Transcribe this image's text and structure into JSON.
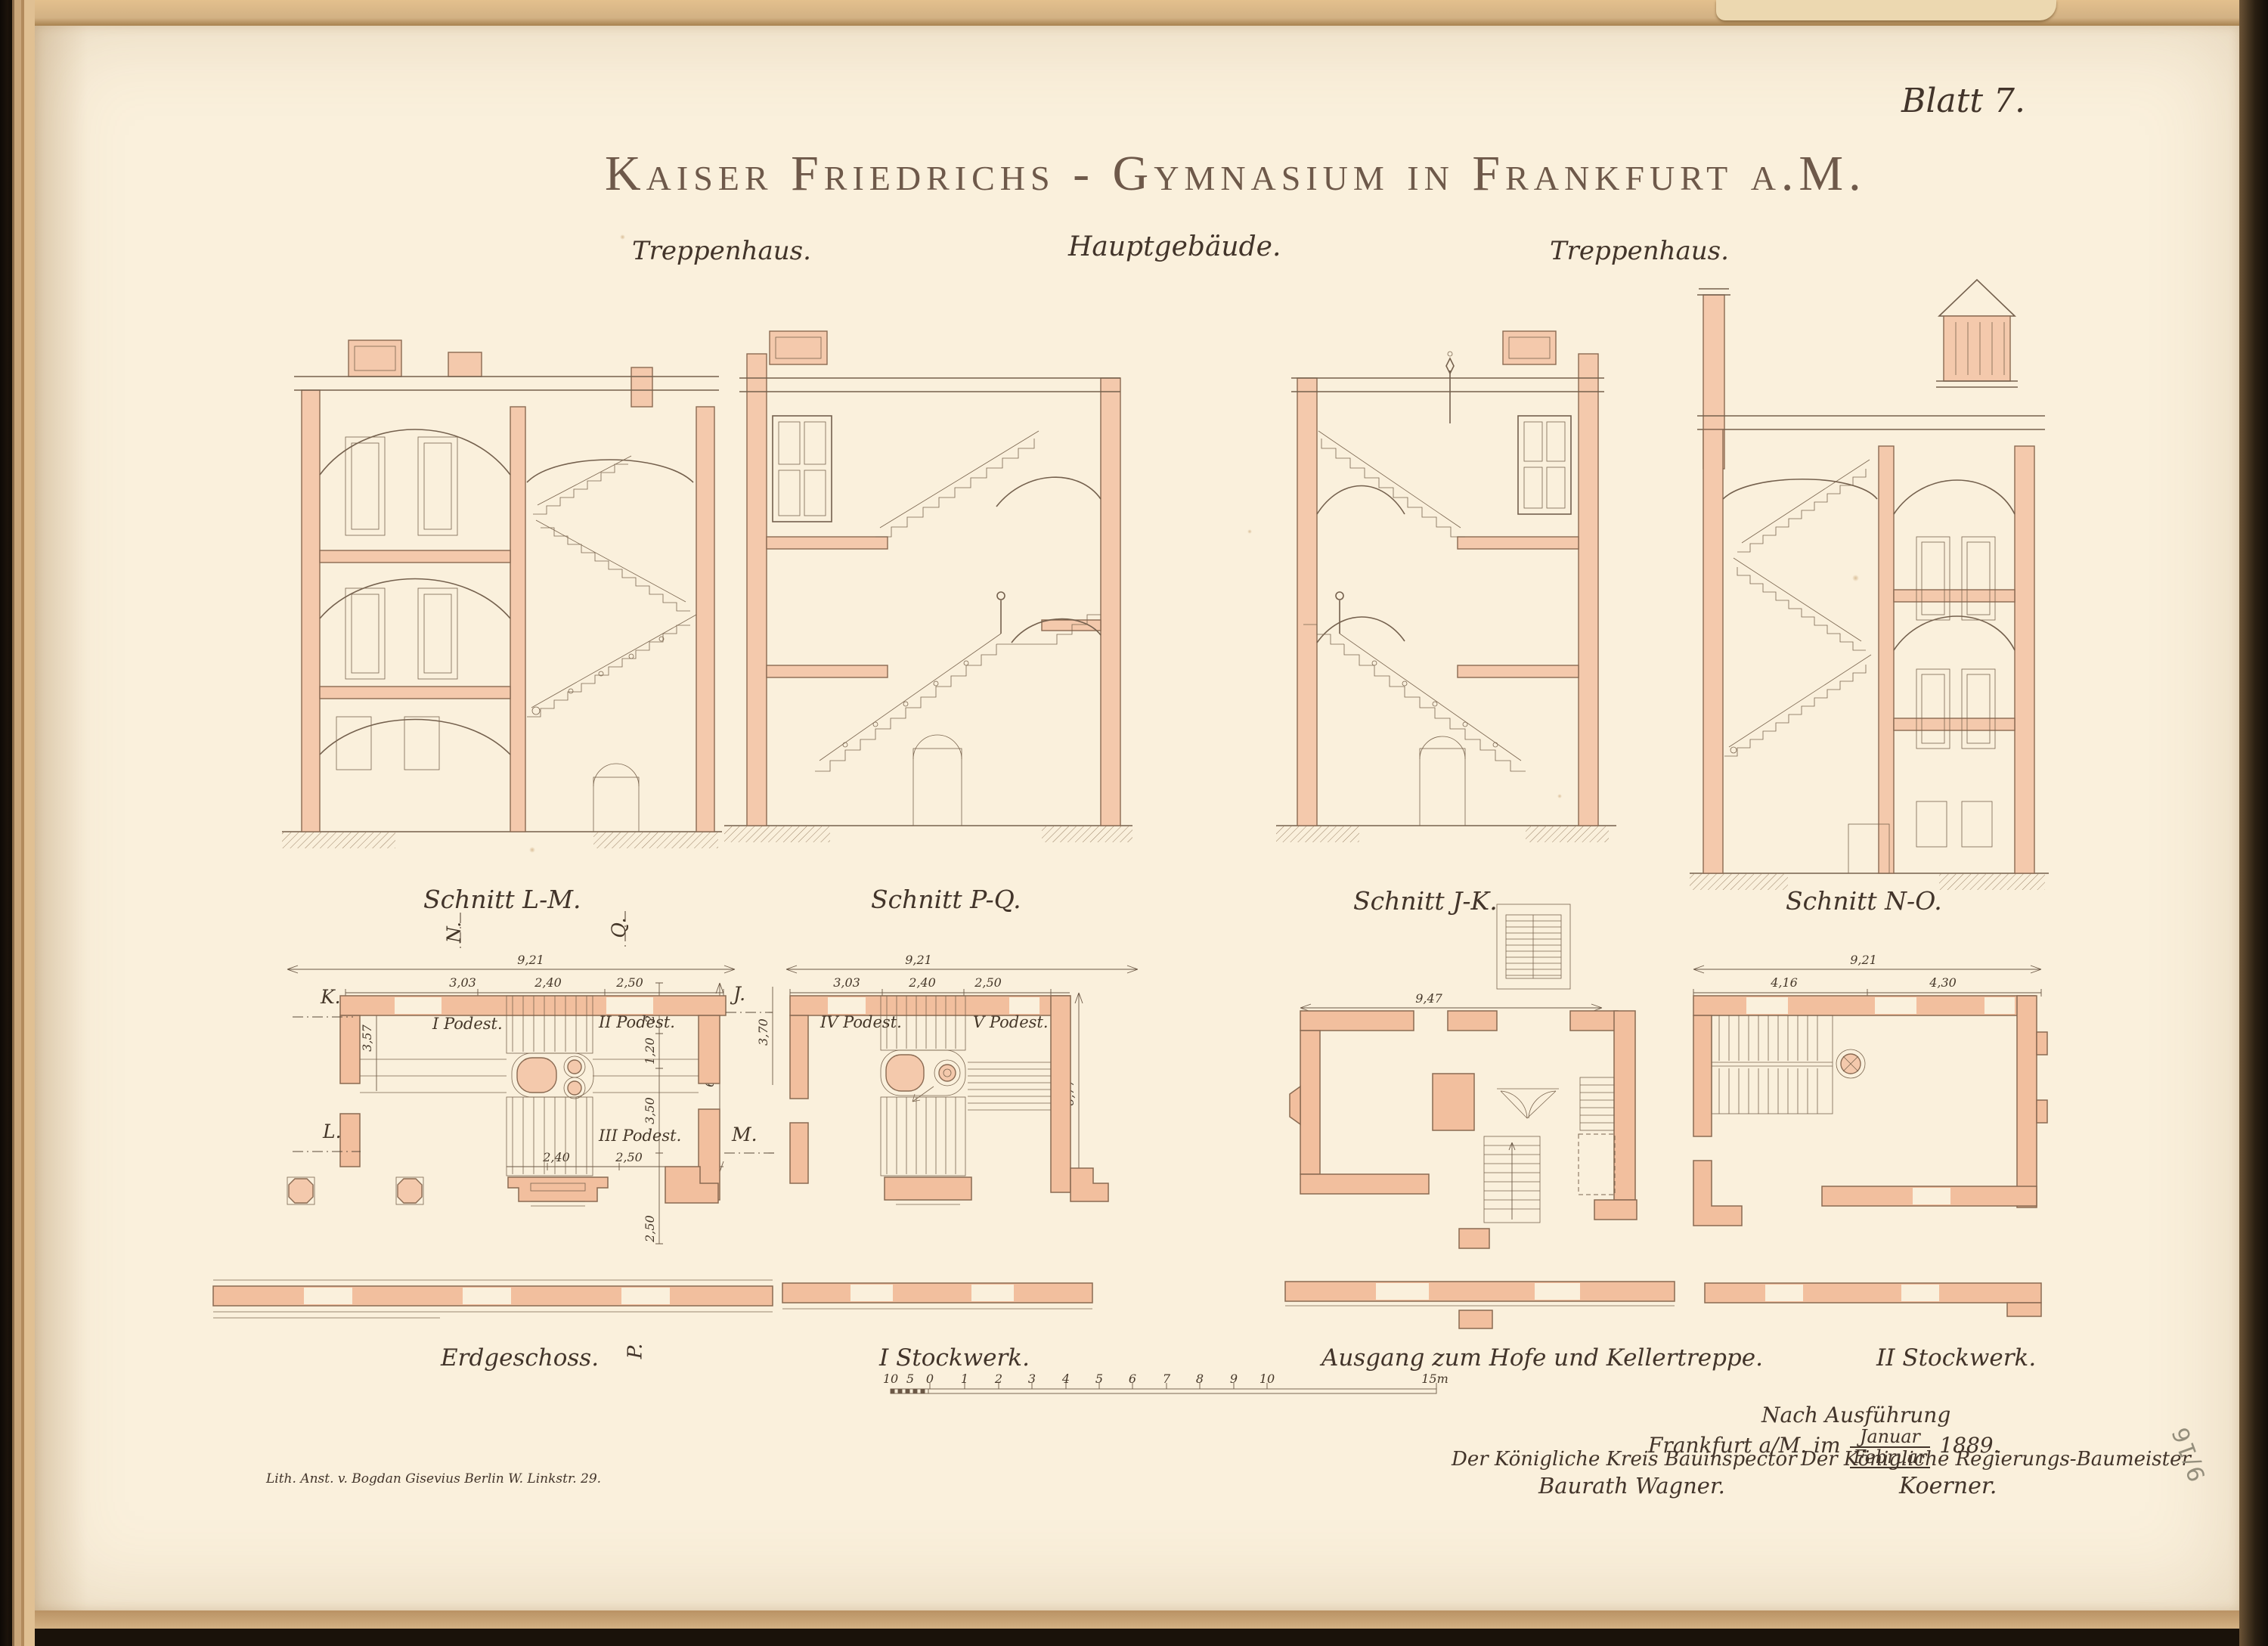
{
  "page": {
    "sheet_number": "Blatt 7.",
    "title": "Kaiser Friedrichs - Gymnasium in Frankfurt a.M.",
    "pencil_note": "9/16",
    "imprint": "Lith. Anst. v. Bogdan Gisevius Berlin W. Linkstr. 29."
  },
  "labels": {
    "treppenhaus_left": "Treppenhaus.",
    "hauptgebaeude": "Hauptgebäude.",
    "treppenhaus_right": "Treppenhaus."
  },
  "sections": {
    "lm": "Schnitt L-M.",
    "pq": "Schnitt P-Q.",
    "jk": "Schnitt J-K.",
    "no": "Schnitt N-O."
  },
  "plans": {
    "erdgeschoss": {
      "caption": "Erdgeschoss.",
      "podest1": "I Podest.",
      "podest2": "II Podest.",
      "podest3": "III Podest.",
      "dim_total": "9,21",
      "dim_a": "3,03",
      "dim_b": "2,40",
      "dim_c": "2,50",
      "dim_r1": "2,50",
      "dim_r2": "1,20",
      "dim_r3": "3,50",
      "dim_r4": "2,50",
      "dim_right_total": "6,77",
      "dim_far_right": "3,70",
      "dim_left": "3,57",
      "dim_bot_a": "2,40",
      "dim_bot_b": "2,50",
      "marker_k": "K.",
      "marker_l": "L.",
      "marker_j": "J.",
      "marker_m": "M.",
      "marker_n": "N.",
      "marker_q": "Q.",
      "marker_p": "P."
    },
    "stockwerk1": {
      "caption": "I Stockwerk.",
      "podest4": "IV Podest.",
      "podest5": "V Podest.",
      "dim_total": "9,21",
      "dim_a": "3,03",
      "dim_b": "2,40",
      "dim_c": "2,50",
      "dim_right": "6,77"
    },
    "ausgang": {
      "caption": "Ausgang zum Hofe und Kellertreppe.",
      "dim_total": "9,47"
    },
    "stockwerk2": {
      "caption": "II Stockwerk.",
      "dim_total": "9,21",
      "dim_a": "4,16",
      "dim_b": "4,30"
    }
  },
  "scale_bar": {
    "left_ticks": [
      "10",
      "5",
      "0"
    ],
    "ticks": [
      "1",
      "2",
      "3",
      "4",
      "5",
      "6",
      "7",
      "8",
      "9",
      "10"
    ],
    "end": "15m"
  },
  "attribution": {
    "line1": "Nach Ausführung",
    "line2_prefix": "Frankfurt a/M. im",
    "month_top": "Januar",
    "month_bottom": "Februar",
    "year": "1889.",
    "left_title": "Der Königliche Kreis Bauinspector",
    "left_name": "Baurath Wagner.",
    "right_title": "Der Königliche Regierungs-Baumeister",
    "right_name": "Koerner."
  }
}
